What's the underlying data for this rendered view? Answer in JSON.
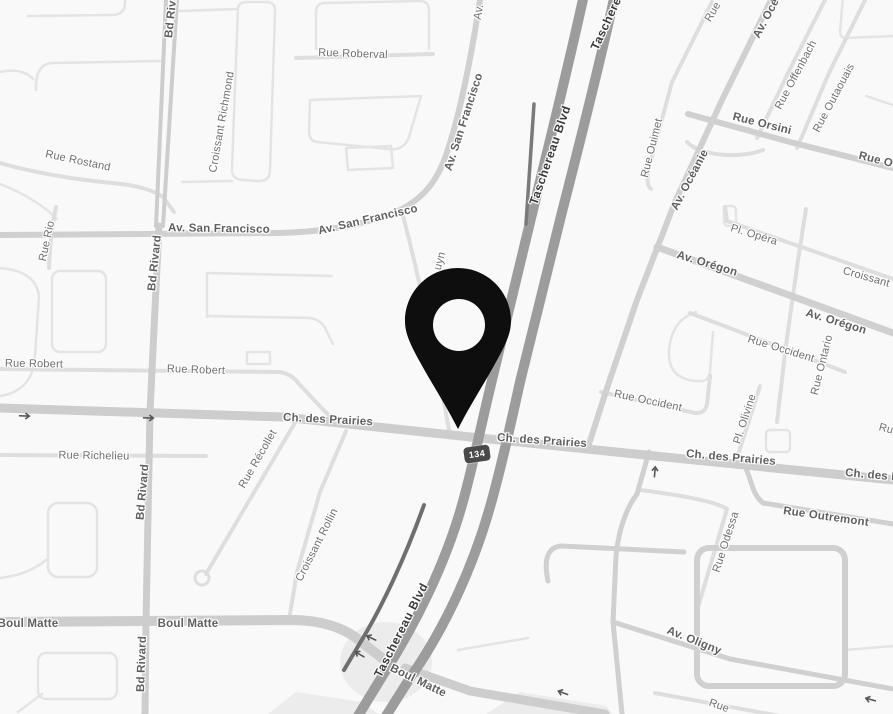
{
  "map": {
    "type": "street-map-grayscale",
    "route_shield": {
      "label": "134",
      "bg_color": "#494949",
      "text_color": "#ffffff"
    },
    "marker": {
      "kind": "location-pin",
      "color": "#0e0e0e"
    },
    "palette": {
      "background": "#f9f9f9",
      "highway": "#9c9c9c",
      "major_road": "#cdcdcd",
      "medium_road": "#d0d0d0",
      "minor_road": "#dedede",
      "block_outline": "#e4e4e4",
      "ramp_dark": "#6f6f6f",
      "label": "#6f6f6f",
      "label_bold": "#5f5f5f",
      "label_dark": "#3a3a3a",
      "arrow": "#555555"
    },
    "icons": {
      "one_way_arrow": "svg-line-arrow",
      "location_pin": "map-pin-glyph"
    },
    "labels": [
      {
        "t": "Rue Roberval",
        "x": 353,
        "y": 54,
        "r": 2,
        "tier": "minor"
      },
      {
        "t": "Av.",
        "x": 479,
        "y": 12,
        "r": -80,
        "tier": "minor"
      },
      {
        "t": "Av. San Francisco",
        "x": 464,
        "y": 122,
        "r": -72,
        "tier": "medium"
      },
      {
        "t": "Av. San Francisco",
        "x": 368,
        "y": 220,
        "r": -13,
        "tier": "medium"
      },
      {
        "t": "Av. San Francisco",
        "x": 219,
        "y": 229,
        "r": 1,
        "tier": "medium"
      },
      {
        "t": "Taschereau Blvd",
        "x": 616,
        "y": 2,
        "r": -65,
        "tier": "dark"
      },
      {
        "t": "Taschereau Blvd",
        "x": 550,
        "y": 155,
        "r": -71,
        "tier": "dark"
      },
      {
        "t": "Taschereau Blvd",
        "x": 401,
        "y": 630,
        "r": -63,
        "tier": "dark"
      },
      {
        "t": "Bd Rivard",
        "x": 172,
        "y": 10,
        "r": -84,
        "tier": "medium"
      },
      {
        "t": "Bd Rivard",
        "x": 155,
        "y": 263,
        "r": -84,
        "tier": "medium"
      },
      {
        "t": "Bd Rivard",
        "x": 143,
        "y": 492,
        "r": -85,
        "tier": "medium"
      },
      {
        "t": "Bd Rivard",
        "x": 142,
        "y": 664,
        "r": -88,
        "tier": "medium"
      },
      {
        "t": "Croissant Richmond",
        "x": 222,
        "y": 122,
        "r": -80,
        "tier": "minor"
      },
      {
        "t": "Rue Rostand",
        "x": 78,
        "y": 161,
        "r": 12,
        "tier": "minor"
      },
      {
        "t": "Rue Rio",
        "x": 47,
        "y": 241,
        "r": -78,
        "tier": "minor"
      },
      {
        "t": "Rue Robert",
        "x": 34,
        "y": 364,
        "r": 1,
        "tier": "minor"
      },
      {
        "t": "Rue Robert",
        "x": 196,
        "y": 370,
        "r": 2,
        "tier": "minor"
      },
      {
        "t": "Rue Richelieu",
        "x": 94,
        "y": 456,
        "r": 1,
        "tier": "minor"
      },
      {
        "t": "Rue Récollet",
        "x": 258,
        "y": 459,
        "r": -60,
        "tier": "minor"
      },
      {
        "t": "Croissant Rollin",
        "x": 317,
        "y": 545,
        "r": -63,
        "tier": "minor"
      },
      {
        "t": "Ch. des Prairies",
        "x": 328,
        "y": 420,
        "r": 3,
        "tier": "medium"
      },
      {
        "t": "Ch. des Prairies",
        "x": 542,
        "y": 441,
        "r": 4,
        "tier": "medium"
      },
      {
        "t": "Ch. des Prairies",
        "x": 731,
        "y": 458,
        "r": 5,
        "tier": "medium"
      },
      {
        "t": "Ch. des Prairies",
        "x": 890,
        "y": 477,
        "r": 5,
        "tier": "medium"
      },
      {
        "t": "Boul Matte",
        "x": 28,
        "y": 624,
        "r": 0,
        "tier": "medium"
      },
      {
        "t": "Boul Matte",
        "x": 188,
        "y": 624,
        "r": 0,
        "tier": "medium"
      },
      {
        "t": "Boul Matte",
        "x": 418,
        "y": 681,
        "r": 26,
        "tier": "medium"
      },
      {
        "t": "Av. Oligny",
        "x": 694,
        "y": 641,
        "r": 22,
        "tier": "medium"
      },
      {
        "t": "Rue Odessa",
        "x": 726,
        "y": 542,
        "r": -72,
        "tier": "minor"
      },
      {
        "t": "Rue Outremont",
        "x": 826,
        "y": 517,
        "r": 8,
        "tier": "medium"
      },
      {
        "t": "Av. Océanie",
        "x": 772,
        "y": 8,
        "r": -62,
        "tier": "medium"
      },
      {
        "t": "Av. Océanie",
        "x": 690,
        "y": 180,
        "r": -62,
        "tier": "medium"
      },
      {
        "t": "Rue Ouimet",
        "x": 652,
        "y": 148,
        "r": -76,
        "tier": "minor"
      },
      {
        "t": "Rue",
        "x": 713,
        "y": 12,
        "r": -60,
        "tier": "minor"
      },
      {
        "t": "Rue Offenbach",
        "x": 796,
        "y": 75,
        "r": -62,
        "tier": "minor"
      },
      {
        "t": "Rue Outaouais",
        "x": 834,
        "y": 98,
        "r": -62,
        "tier": "minor"
      },
      {
        "t": "Rue Orsini",
        "x": 762,
        "y": 124,
        "r": 14,
        "tier": "medium"
      },
      {
        "t": "Rue Orsini",
        "x": 888,
        "y": 163,
        "r": 14,
        "tier": "medium"
      },
      {
        "t": "Pl. Opéra",
        "x": 754,
        "y": 235,
        "r": 17,
        "tier": "minor"
      },
      {
        "t": "Croissant O",
        "x": 872,
        "y": 279,
        "r": 16,
        "tier": "minor"
      },
      {
        "t": "Av. Orégon",
        "x": 707,
        "y": 264,
        "r": 17,
        "tier": "medium"
      },
      {
        "t": "Av. Orégon",
        "x": 836,
        "y": 322,
        "r": 17,
        "tier": "medium"
      },
      {
        "t": "Rue Occident",
        "x": 781,
        "y": 349,
        "r": 17,
        "tier": "minor"
      },
      {
        "t": "Rue Ontario",
        "x": 822,
        "y": 365,
        "r": -76,
        "tier": "minor"
      },
      {
        "t": "Rue Occident",
        "x": 648,
        "y": 401,
        "r": 12,
        "tier": "minor"
      },
      {
        "t": "Pl. Olivine",
        "x": 745,
        "y": 419,
        "r": -72,
        "tier": "minor"
      },
      {
        "t": "uyn",
        "x": 440,
        "y": 261,
        "r": -75,
        "tier": "minor"
      },
      {
        "t": "Rue",
        "x": 719,
        "y": 706,
        "r": 20,
        "tier": "minor"
      },
      {
        "t": "Ru",
        "x": 886,
        "y": 429,
        "r": 15,
        "tier": "minor"
      }
    ],
    "arrows": [
      {
        "x": 26,
        "y": 411,
        "r": 2
      },
      {
        "x": 150,
        "y": 413,
        "r": 2
      },
      {
        "x": 650,
        "y": 470,
        "r": -85
      },
      {
        "x": 368,
        "y": 642,
        "r": 205
      },
      {
        "x": 356,
        "y": 658,
        "r": 210
      },
      {
        "x": 560,
        "y": 697,
        "r": 200
      },
      {
        "x": 868,
        "y": 704,
        "r": 195
      }
    ]
  }
}
